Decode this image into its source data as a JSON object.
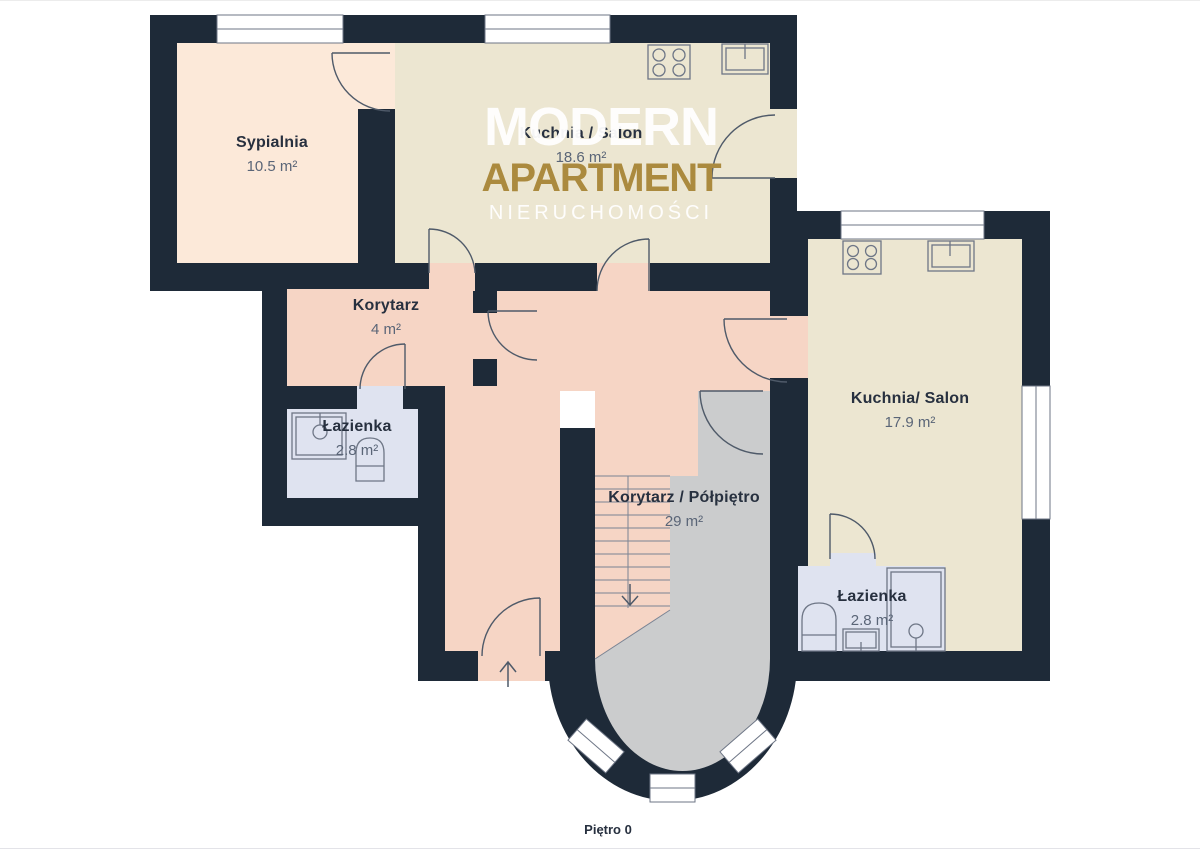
{
  "floor_plan": {
    "floor_label": "Piętro 0",
    "watermark": {
      "line1": "MODERN",
      "line2": "APARTMENT",
      "line3": "NIERUCHOMOŚCI"
    },
    "rooms": [
      {
        "id": "sypialnia",
        "name": "Sypialnia",
        "area": "10.5 m²"
      },
      {
        "id": "kuchnia-salon-gorna",
        "name": "Kuchnia / Salon",
        "area": "18.6 m²"
      },
      {
        "id": "korytarz",
        "name": "Korytarz",
        "area": "4 m²"
      },
      {
        "id": "lazienka-lewa",
        "name": "Łazienka",
        "area": "2.8 m²"
      },
      {
        "id": "korytarz-polpietro",
        "name": "Korytarz / Półpiętro",
        "area": "29 m²"
      },
      {
        "id": "kuchnia-salon-prawa",
        "name": "Kuchnia/ Salon",
        "area": "17.9 m²"
      },
      {
        "id": "lazienka-prawa",
        "name": "Łazienka",
        "area": "2.8 m²"
      }
    ],
    "fixtures": [
      "stove",
      "kitchen-sink",
      "shower",
      "toilet",
      "washbasin",
      "staircase",
      "entrance-arrow"
    ],
    "colors": {
      "wall": "#1e2a38",
      "bedroom_floor": "#fce9d9",
      "kitchen_floor": "#ece6d1",
      "corridor_floor": "#f6d5c5",
      "bathroom_floor": "#dfe3f0",
      "mezzanine_floor": "#cbcccd",
      "watermark_gold": "#ab8a3e"
    }
  }
}
